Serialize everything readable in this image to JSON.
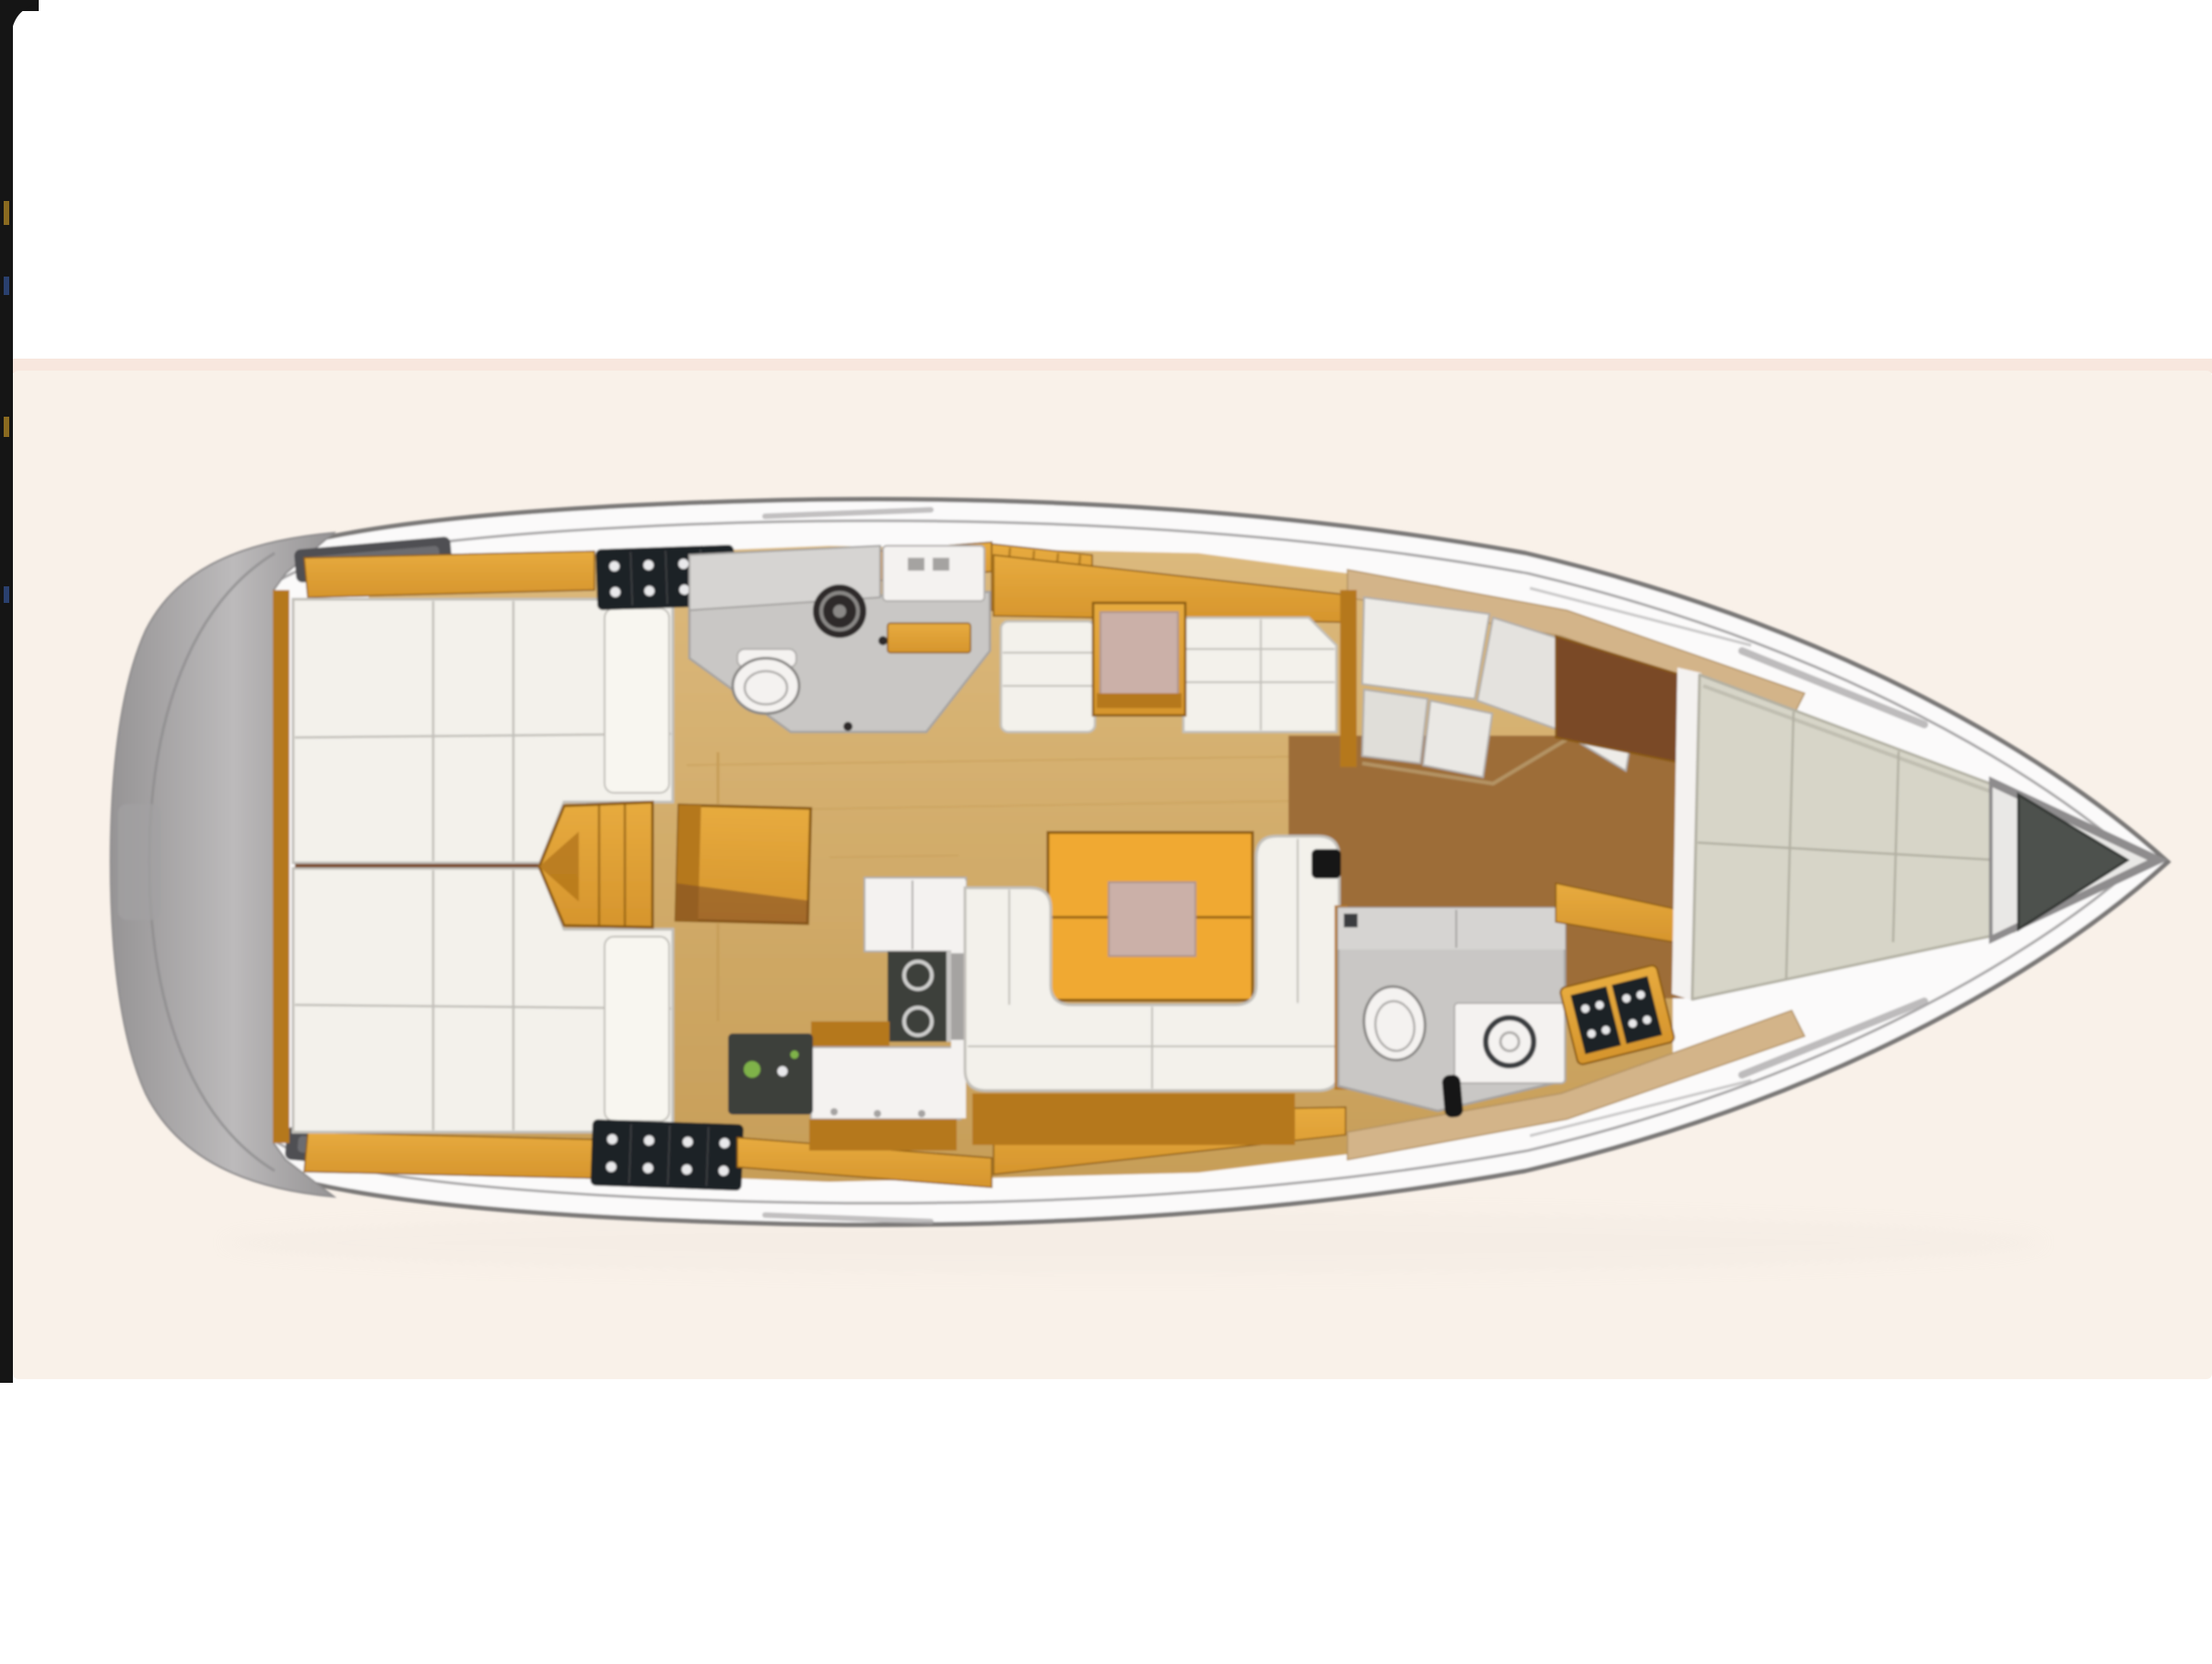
{
  "figure": {
    "type": "floor-plan",
    "subject": "sailboat-interior-top-view",
    "orientation": "bow-right-stern-left",
    "visible_text": []
  },
  "palette": {
    "pageBg": "#ffffff",
    "edgeStrip": "#151515",
    "edgeSpeckGold": "#8a6a20",
    "edgeSpeckBlue": "#2a406e",
    "canvasBg": "#f9f1e9",
    "canvasTopTint": "#f8e7de",
    "hullShadow": "#d9d2ca",
    "deckWhite": "#fbfafa",
    "hullStroke": "#7a7877",
    "deckLine": "#a9a7a8",
    "sternLight": "#bcbabb",
    "sternDark": "#969495",
    "sternSeam": "#8f8d8e",
    "ladderRecess": "#a3a1a2",
    "hatchDark": "#4f4f52",
    "hatchInner": "#6c6c6f",
    "bowWedgeGray": "#8e8c8d",
    "bowGapWhite": "#e9e8e6",
    "anchorDark": "#4d514e",
    "anchorStroke": "#353936",
    "amber": "#d6952d",
    "amberLight": "#e7ab3f",
    "amberDark": "#8a5a10",
    "amberDeep": "#b5781c",
    "tableAmber": "#f0a930",
    "tanFloor": "#dcb97c",
    "tanFloorDark": "#c79e58",
    "hullWoodBand": "#d3b489",
    "hullWoodStroke": "#b39363",
    "walnut": "#9d6d38",
    "walnutDark": "#7a4826",
    "berthWhite": "#f3f1eb",
    "berthSeam": "#c2c0ba",
    "pillowWhite": "#f8f6f0",
    "vberthGray": "#d7d5c8",
    "vberthSeam": "#b2b0a3",
    "grayCounter": "#d6d4d2",
    "grayFloor": "#c9c7c5",
    "grayStroke": "#a5a3a1",
    "fixtureWhite": "#f4f2f0",
    "fixtureStroke": "#b0aeac",
    "sinkDark": "#2e2c2a",
    "sinkRing": "#8a8886",
    "lockerBlack": "#1f2125",
    "lockerLine": "#3a3c40",
    "dotWhite": "#e9e9eb",
    "dotRed": "#a03028",
    "dotNavy": "#2a3a6a",
    "ovenDark": "#3e3f3b",
    "ovenGreen": "#7fb24a",
    "stoveRing": "#cfcfcd",
    "pinkMat": "#cbb0a8",
    "pinkStroke": "#ae948c",
    "blackBox": "#191919",
    "panelA": "#edebe7",
    "panelB": "#e4e2de",
    "panelC": "#eeece8",
    "panelD": "#e0ded9",
    "panelE": "#eae8e4"
  },
  "regions": [
    {
      "name": "stern-transom",
      "fill": "sternLight"
    },
    {
      "name": "port-aft-deck-hatch",
      "fill": "hatchDark"
    },
    {
      "name": "starboard-aft-deck-hatch",
      "fill": "hatchDark"
    },
    {
      "name": "port-aft-cabin-berth",
      "fill": "berthWhite"
    },
    {
      "name": "starboard-aft-cabin-berth",
      "fill": "berthWhite"
    },
    {
      "name": "port-aft-locker",
      "fill": "lockerBlack"
    },
    {
      "name": "starboard-aft-locker",
      "fill": "lockerBlack"
    },
    {
      "name": "companionway-steps",
      "fill": "amber"
    },
    {
      "name": "chart-table",
      "fill": "amber"
    },
    {
      "name": "aft-head-port",
      "fill": "grayFloor"
    },
    {
      "name": "galley-starboard",
      "fill": "fixtureWhite"
    },
    {
      "name": "port-settee",
      "fill": "berthWhite"
    },
    {
      "name": "port-side-table",
      "fill": "pinkMat"
    },
    {
      "name": "salon-u-settee",
      "fill": "berthWhite"
    },
    {
      "name": "salon-table",
      "fill": "tableAmber"
    },
    {
      "name": "forward-head-port",
      "fill": "panelA"
    },
    {
      "name": "forward-head-starboard",
      "fill": "grayFloor"
    },
    {
      "name": "forward-cabin-v-berth",
      "fill": "vberthGray"
    },
    {
      "name": "anchor-locker",
      "fill": "anchorDark"
    },
    {
      "name": "side-deck",
      "fill": "deckWhite"
    },
    {
      "name": "salon-sole",
      "fill": "tanFloor"
    },
    {
      "name": "forward-cabin-sole",
      "fill": "walnut"
    }
  ]
}
